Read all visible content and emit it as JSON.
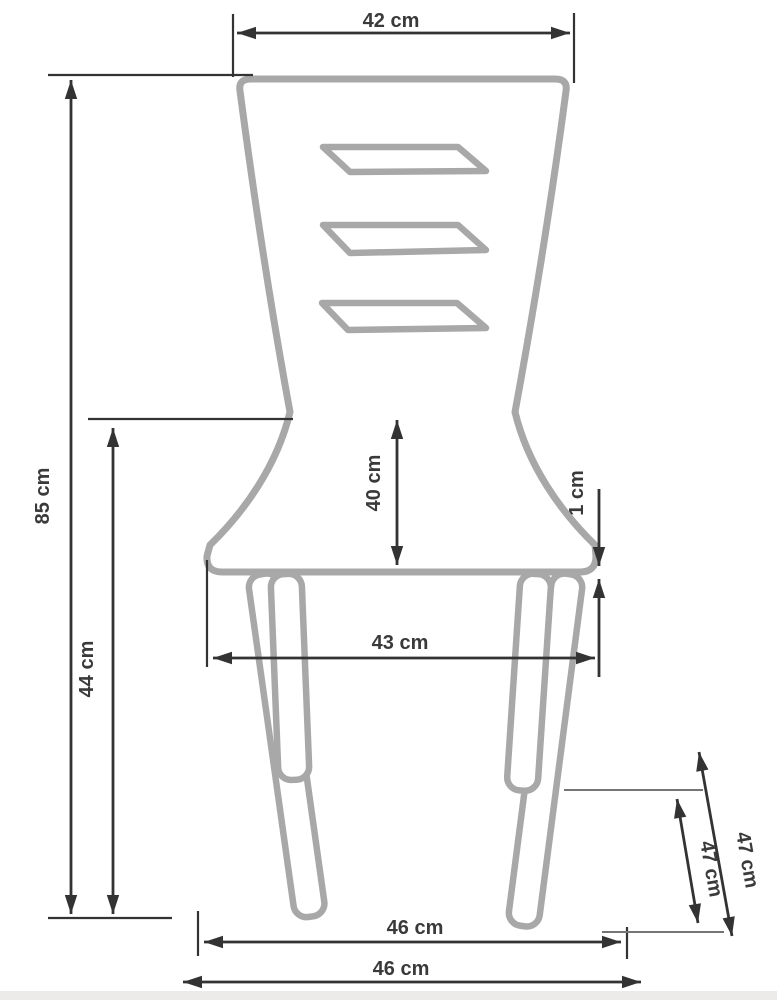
{
  "diagram": {
    "subject": "chair-dimension-drawing-front-view",
    "unit": "cm",
    "dimensions": {
      "top_width": "42 cm",
      "overall_height": "85 cm",
      "seat_height": "44 cm",
      "backrest_height": "40 cm",
      "seat_edge_thickness": "1 cm",
      "seat_width": "43 cm",
      "front_leg_stance": "46 cm",
      "overall_base_width": "46 cm",
      "rear_leg_length": "47 cm",
      "front_leg_length": "47 cm"
    },
    "colors": {
      "chair_outline": "#a8a8a8",
      "dimension_lines": "#333333",
      "label_text": "#3a3a3a",
      "background": "#ffffff",
      "footer_strip": "#ecebe9"
    }
  }
}
